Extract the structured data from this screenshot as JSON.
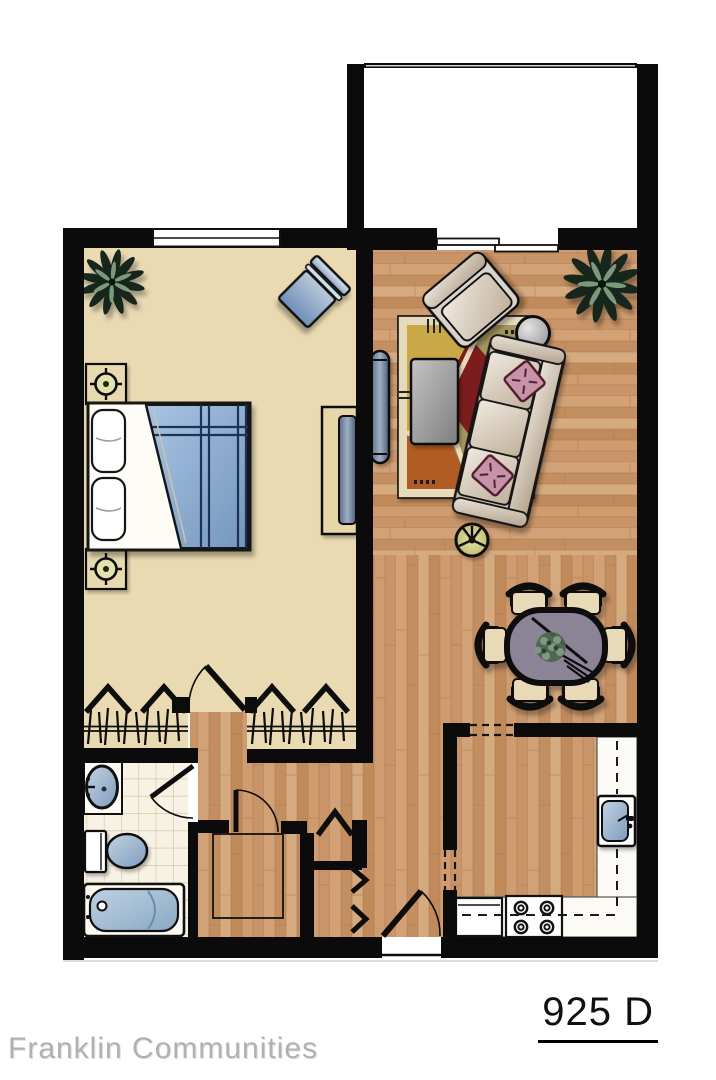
{
  "page": {
    "width": 716,
    "height": 1080,
    "background": "#ffffff"
  },
  "plan": {
    "unit_label": "925 D",
    "brand_label": "Franklin Communities",
    "rooms": [
      "bedroom",
      "living-room",
      "dining-area",
      "kitchen",
      "bathroom",
      "hallway",
      "balcony",
      "walk-in-closet",
      "bedroom-closets",
      "hall-closets"
    ],
    "furniture_icons": [
      "bed-icon",
      "nightstand-lamp-icon",
      "dresser-tv-icon",
      "accent-chair-icon",
      "plant-icon",
      "sofa-icon",
      "armchair-icon",
      "round-side-table-icon",
      "coffee-table-icon",
      "tv-console-icon",
      "area-rug-icon",
      "floor-lamp-icon",
      "dining-table-icon",
      "dining-chair-icon",
      "kitchen-sink-icon",
      "stove-icon",
      "refrigerator-icon",
      "bathroom-sink-icon",
      "toilet-icon",
      "bathtub-icon",
      "door-swing-icon",
      "bifold-door-icon",
      "accordion-door-icon",
      "sliding-door-icon",
      "window-icon",
      "closet-rod-icon"
    ],
    "colors": {
      "wall": "#0b0b0b",
      "wood_floor": "#cd9a6e",
      "carpet": "#eadab2",
      "tile": "#f7f2e4",
      "balcony": "#ffffff",
      "furniture_blue": "#7e9cc0",
      "rug_red": "#7d1a1a",
      "rug_gold": "#c9a845",
      "rug_olive": "#8d9157",
      "rug_rust": "#b05c20",
      "pillow_pink": "#c793a9",
      "dining_table": "#8b8496",
      "fixture_blue": "#9ab4cc",
      "lamp_yellow": "#d3d089",
      "brand_text": "#b2b0b0",
      "unit_text": "#111111"
    }
  }
}
